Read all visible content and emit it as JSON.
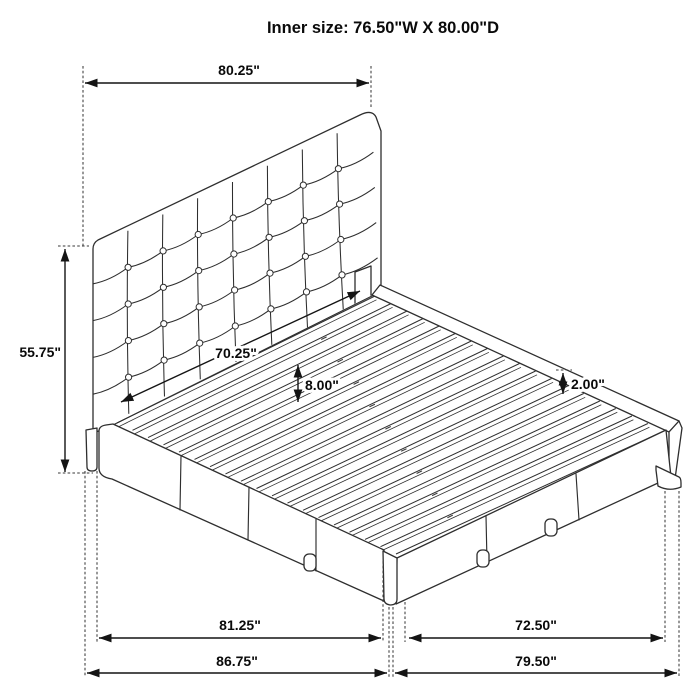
{
  "title": "Inner size: 76.50\"W X 80.00\"D",
  "dimensions": {
    "headboard_width": "80.25\"",
    "headboard_height": "55.75\"",
    "inner_width": "70.25\"",
    "slat_height": "8.00\"",
    "rail_lip": "2.00\"",
    "base_front_inner": "81.25\"",
    "base_side_inner": "72.50\"",
    "base_front_outer": "86.75\"",
    "base_side_outer": "79.50\""
  },
  "colors": {
    "ink": "#2e2e2e",
    "dim_ink": "#141414",
    "background": "#ffffff"
  }
}
